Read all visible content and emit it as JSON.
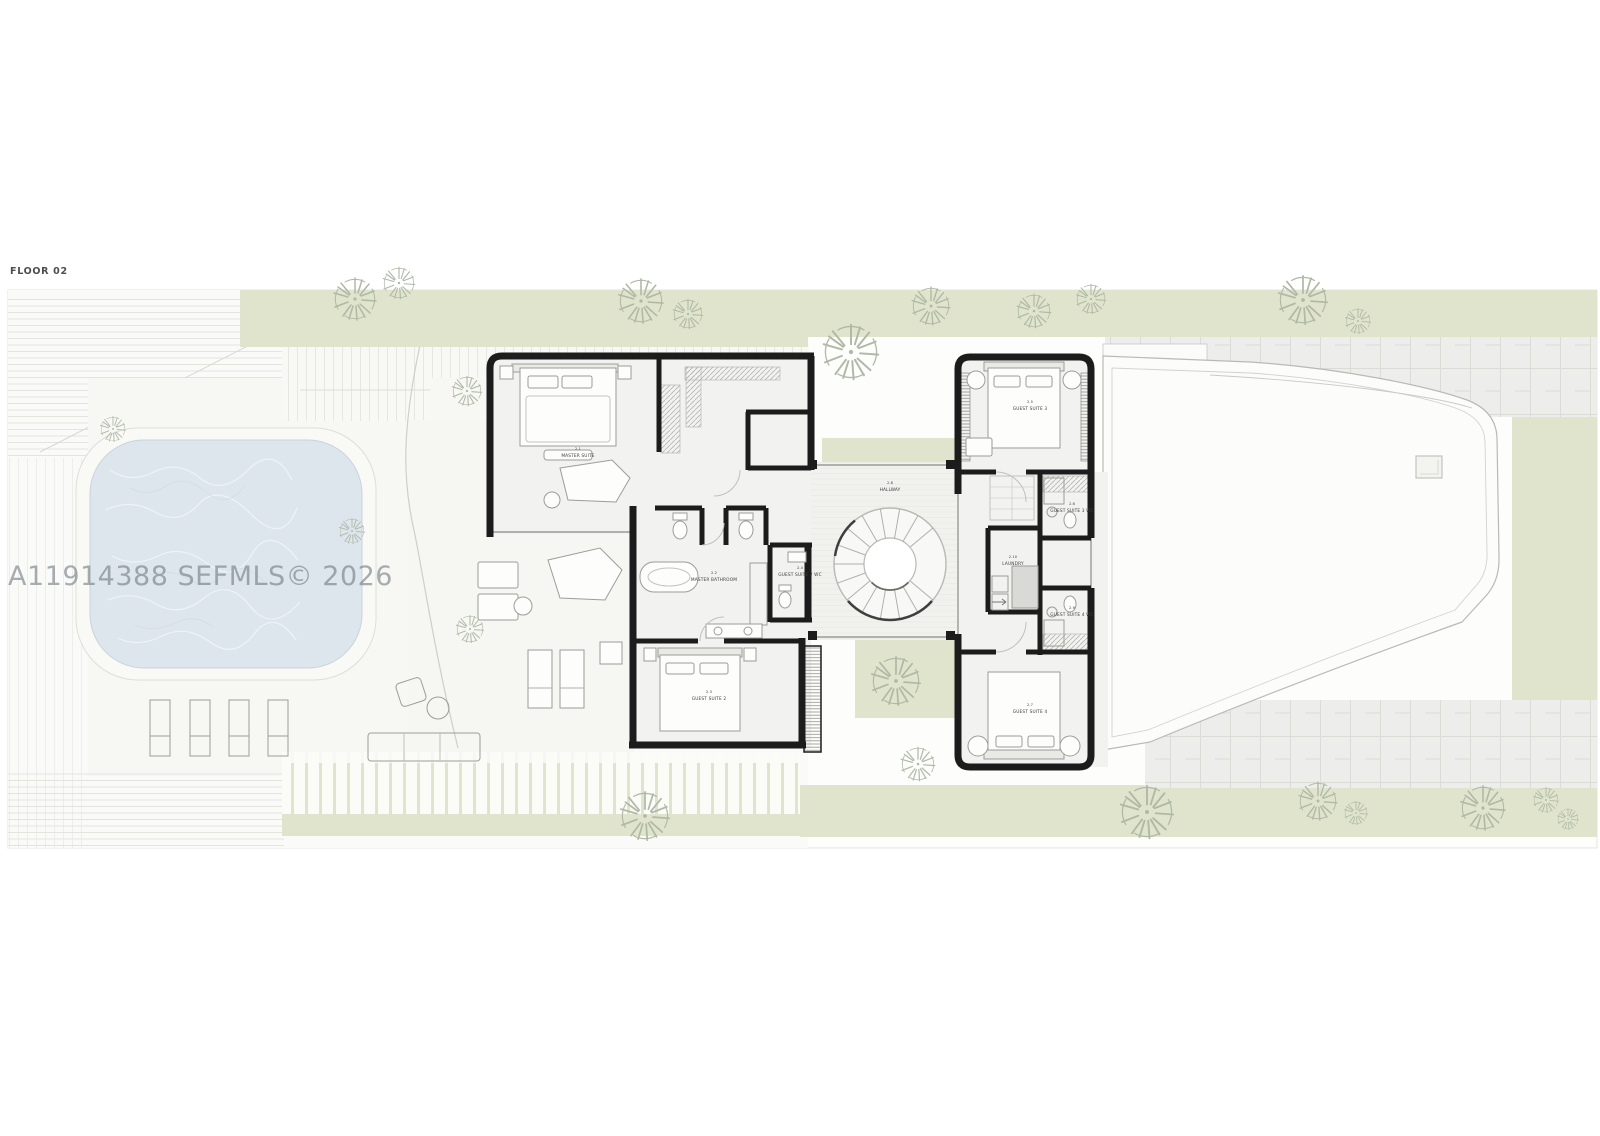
{
  "page": {
    "floor_label": "FLOOR 02",
    "watermark": "A11914388  SEFMLS© 2026"
  },
  "rooms": [
    {
      "id": "master-suite",
      "num": "2.1",
      "name": "MASTER SUITE"
    },
    {
      "id": "master-bathroom",
      "num": "2.2",
      "name": "MASTER BATHROOM"
    },
    {
      "id": "guest-suite-2",
      "num": "2.3",
      "name": "GUEST SUITE 2"
    },
    {
      "id": "guest-suite-2-wc",
      "num": "2.4",
      "name": "GUEST SUITE 2 WC"
    },
    {
      "id": "guest-suite-3",
      "num": "2.5",
      "name": "GUEST SUITE 3"
    },
    {
      "id": "guest-suite-3-wc",
      "num": "2.6",
      "name": "GUEST SUITE 3 WC"
    },
    {
      "id": "guest-suite-4",
      "num": "2.7",
      "name": "GUEST SUITE 4"
    },
    {
      "id": "hallway",
      "num": "2.8",
      "name": "HALLWAY"
    },
    {
      "id": "guest-suite-4-wc",
      "num": "2.9",
      "name": "GUEST SUITE 4 WC"
    },
    {
      "id": "laundry",
      "num": "2.10",
      "name": "LAUNDRY"
    }
  ],
  "colors": {
    "wall": "#1c1c1c",
    "green": "#e0e4cc",
    "water": "#dde6ed",
    "deck": "#f7f7f3",
    "roof": "#fcfcfa",
    "tree": "#b0b8a6",
    "watermark": "#6d757d"
  }
}
